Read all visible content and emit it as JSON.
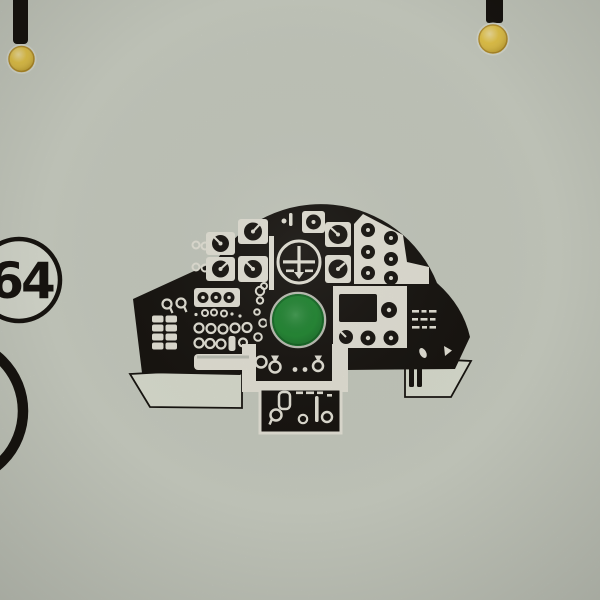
{
  "badge": {
    "number": "64"
  },
  "colors": {
    "paper": "#c9cdc2",
    "paper_shade": "#bfc3b7",
    "paper_light": "#d8dbcf",
    "ink_black": "#181510",
    "ink_white": "#e8e6da",
    "film_white": "#dde0d3",
    "pin_yellow": "#e5c23a",
    "pin_yellow_rim": "#b8922a",
    "scope_green": "#218c33",
    "scope_green_deep": "#166f27"
  }
}
